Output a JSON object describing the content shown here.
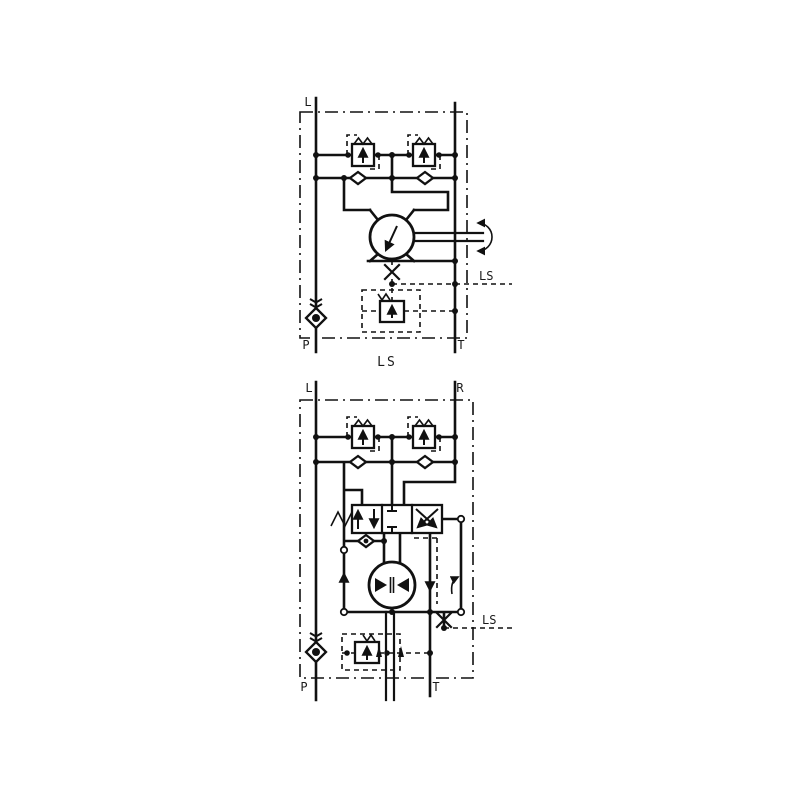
{
  "colors": {
    "background": "#ffffff",
    "line": "#111111",
    "text": "#1a1a1a"
  },
  "diagram_top": {
    "name": "motor-section-schematic",
    "labels": {
      "port_left": "L",
      "ls_line": "LS",
      "port_p": "P",
      "port_t": "T",
      "caption": "LS"
    }
  },
  "diagram_bottom": {
    "name": "steering-unit-schematic",
    "labels": {
      "port_left": "L",
      "port_right": "R",
      "ls_line": "LS",
      "port_p": "P",
      "port_t": "T"
    }
  }
}
